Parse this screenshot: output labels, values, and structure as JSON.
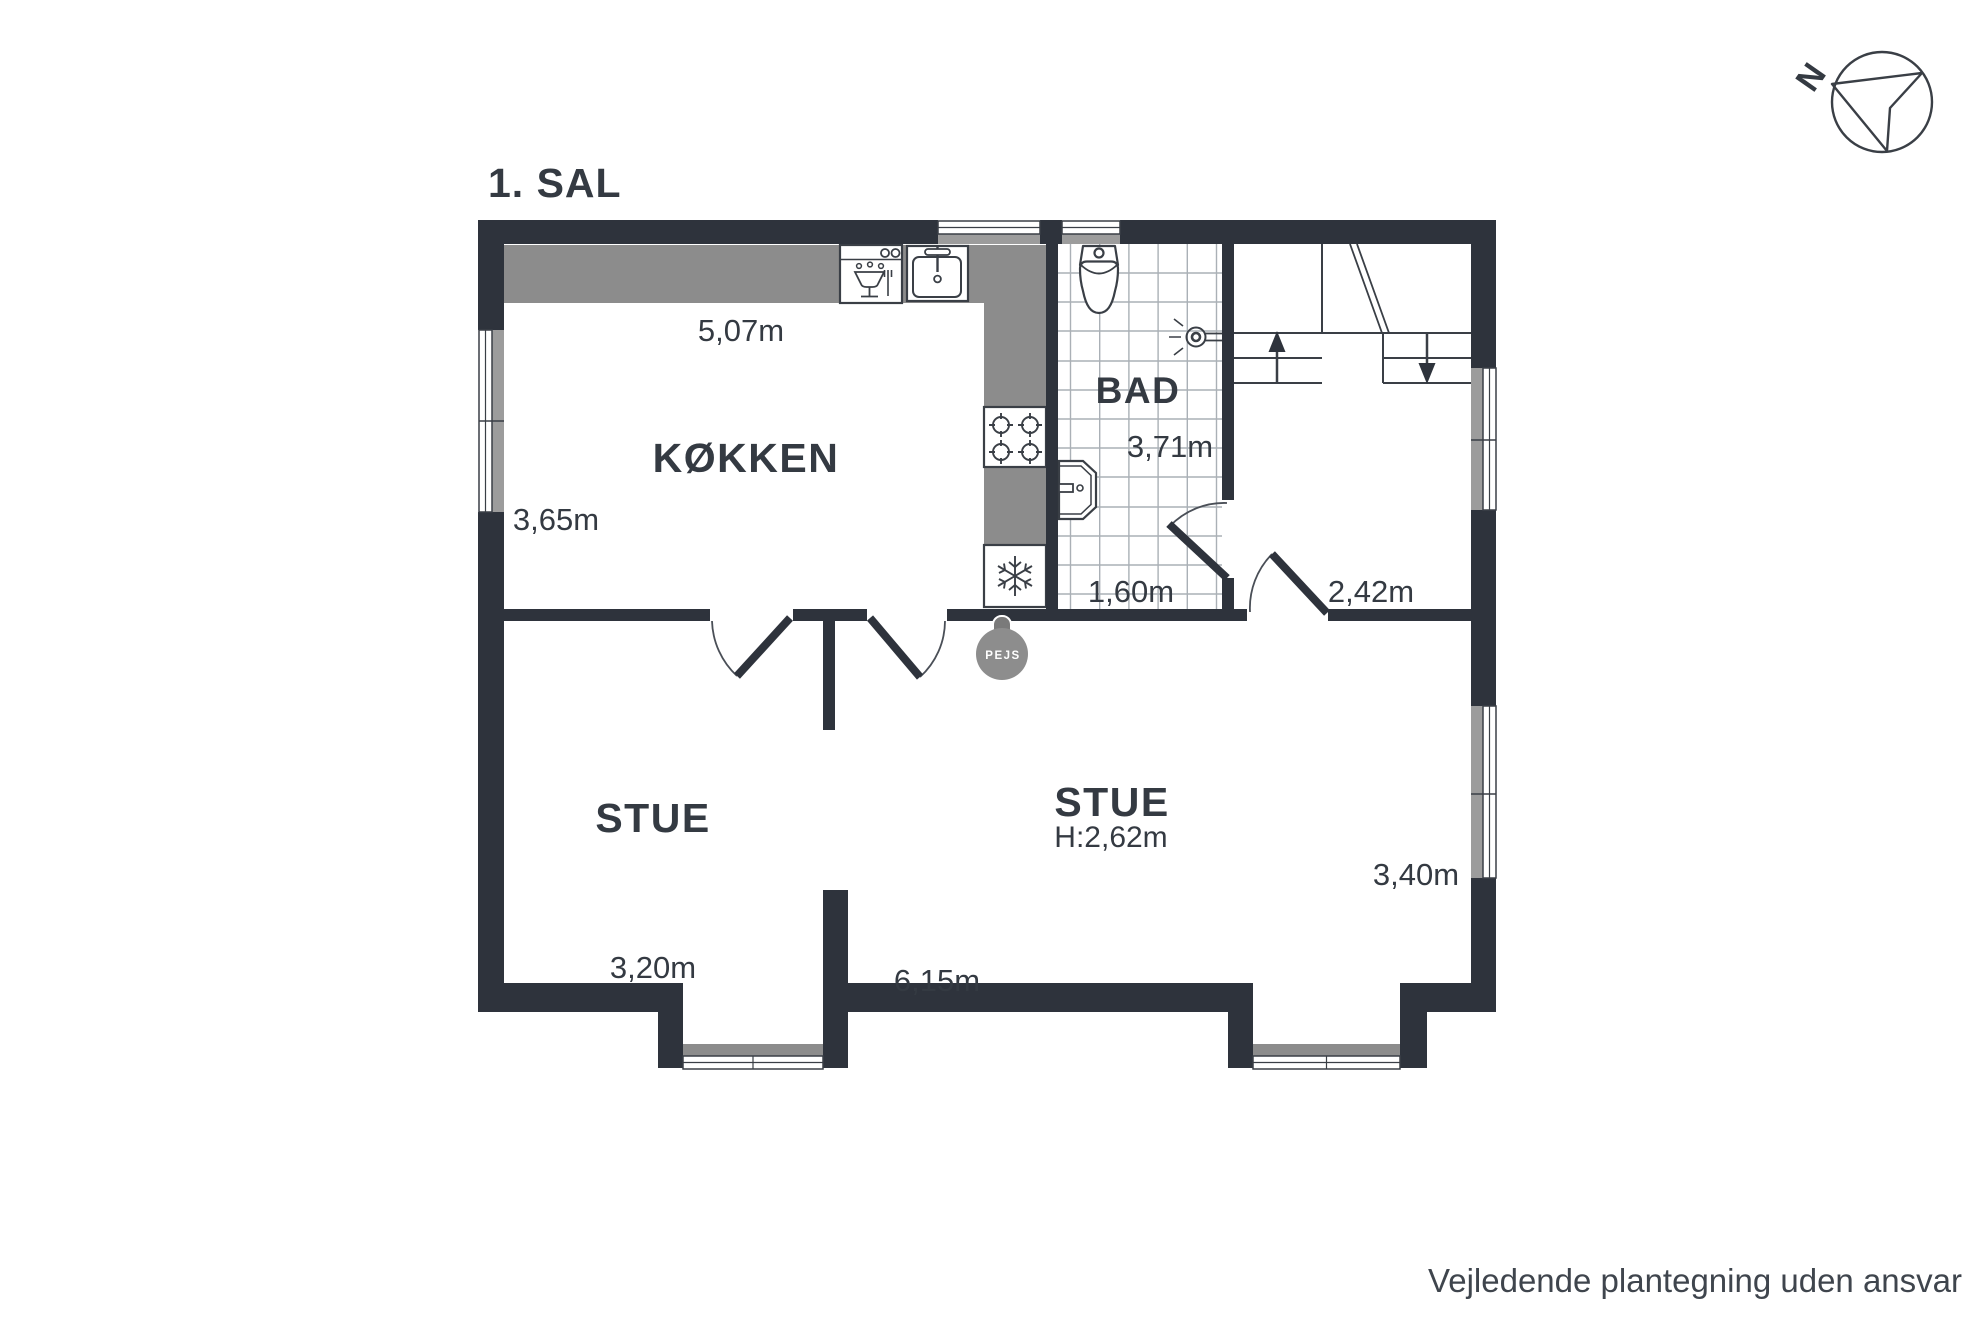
{
  "title": "1. SAL",
  "compass": {
    "north_label": "N"
  },
  "rooms": {
    "kitchen": {
      "label": "KØKKEN",
      "width": "5,07m",
      "depth": "3,65m"
    },
    "bath": {
      "label": "BAD",
      "depth": "3,71m",
      "width": "1,60m"
    },
    "hall": {
      "door_width": "2,42m"
    },
    "stue_left": {
      "label": "STUE",
      "width": "3,20m"
    },
    "stue_right": {
      "label": "STUE",
      "ceiling_height": "H:2,62m",
      "width": "6,15m",
      "depth": "3,40m"
    }
  },
  "fireplace": {
    "label": "PEJS"
  },
  "footer": {
    "disclaimer": "Vejledende plantegning uden ansvar"
  },
  "colors": {
    "wall": "#2e333c",
    "counter": "#8c8c8c",
    "window_gray": "#9c9c9c",
    "tile_grid": "#aab0b6",
    "fireplace_fill": "#8d8d8d",
    "text": "#343a42"
  }
}
